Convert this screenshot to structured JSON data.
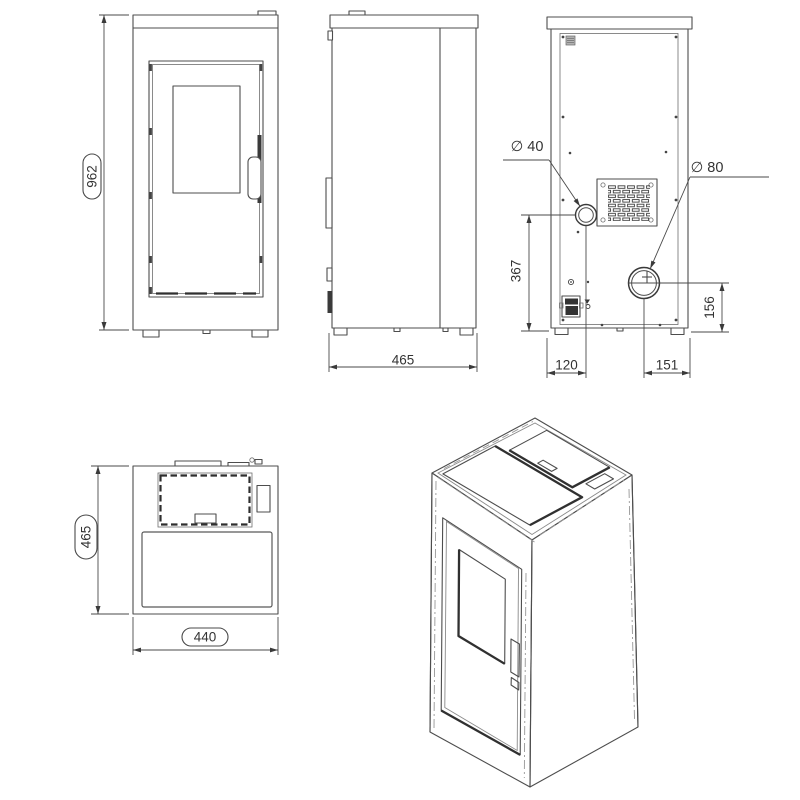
{
  "views": {
    "front": {
      "height": "962"
    },
    "side": {
      "depth": "465"
    },
    "rear": {
      "air_diameter": "∅ 40",
      "flue_diameter": "∅ 80",
      "air_height": "367",
      "flue_height": "156",
      "air_offset": "120",
      "flue_offset": "151"
    },
    "top": {
      "depth": "465",
      "width": "440"
    }
  }
}
